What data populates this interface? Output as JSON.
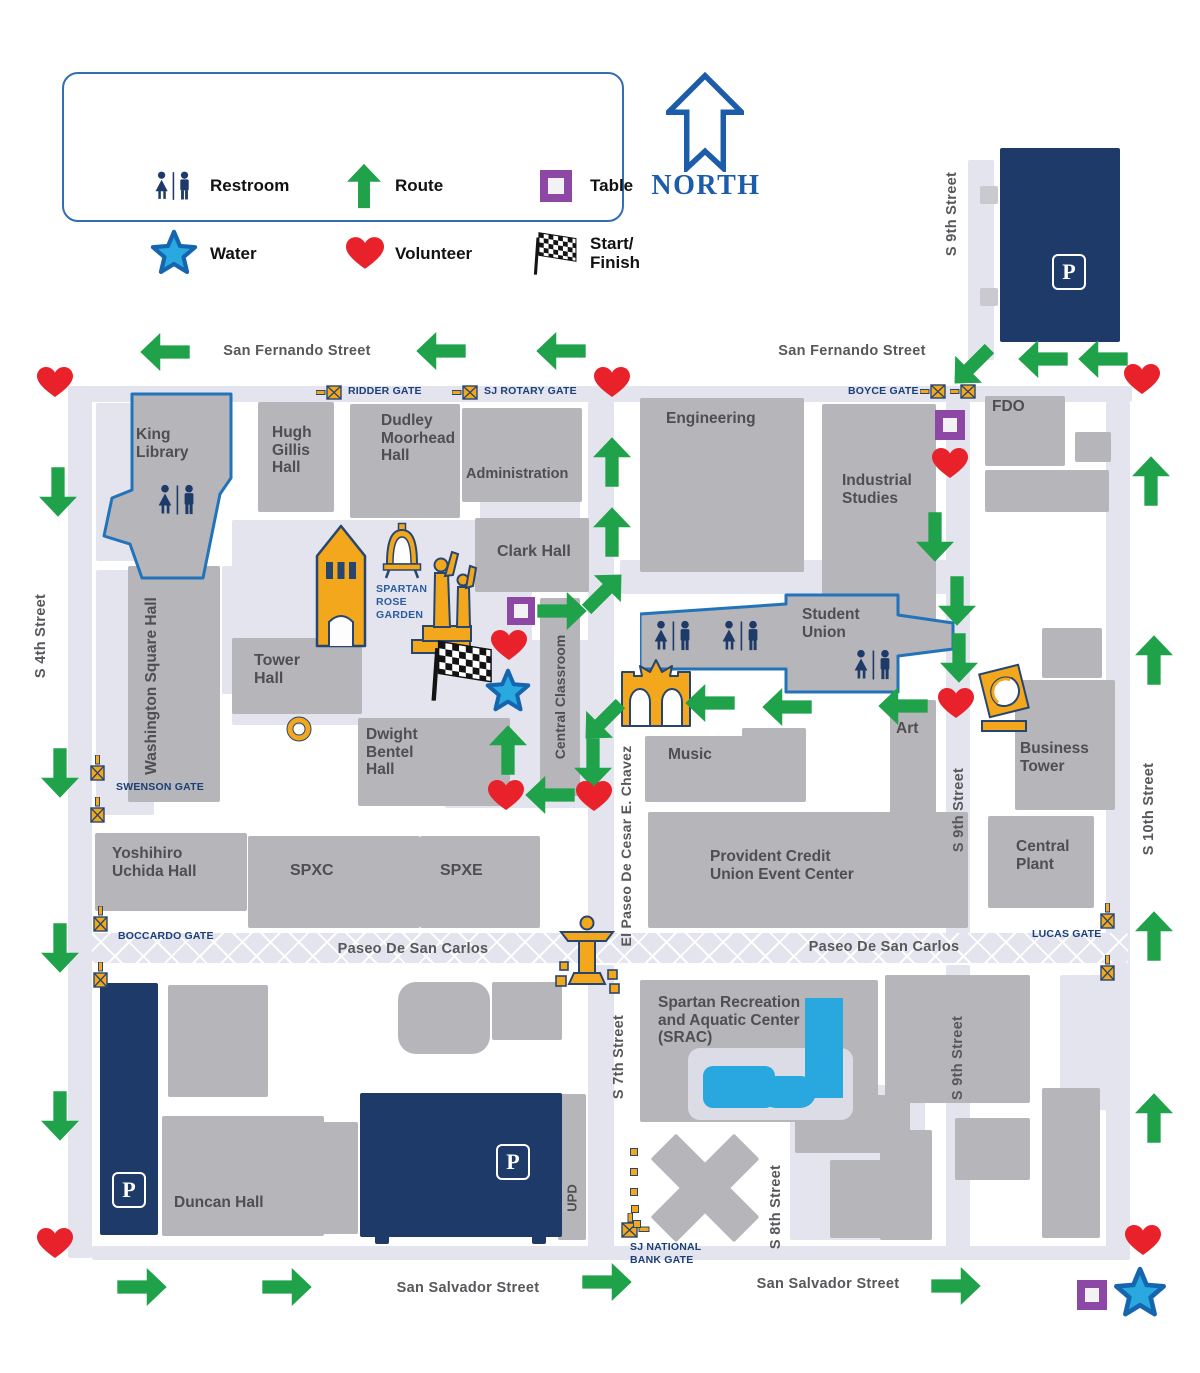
{
  "colors": {
    "green": "#1FA24A",
    "red": "#E8212B",
    "navy": "#1E3A68",
    "gold": "#F3A71D",
    "goldStroke": "#27466F",
    "purple": "#8D48A5",
    "starFill": "#2AA9E1",
    "starStroke": "#1566AF",
    "building": "#B5B5BA",
    "path": "#E4E4EE",
    "buildingText": "#4F4F52",
    "streetText": "#58585C",
    "gateText": "#1B3F77",
    "blueOutline": "#2273B9",
    "northBlue": "#1D5CA9",
    "pool": "#29A8E0",
    "roseText": "#2B5D9E",
    "flagDark": "#131313"
  },
  "legend": {
    "box": {
      "x": 62,
      "y": 72,
      "w": 562,
      "h": 150
    },
    "items": [
      {
        "icon": "restroom-icon",
        "label": "Restroom",
        "ix": 112,
        "iy": 114,
        "lx": 148,
        "ly": 104
      },
      {
        "icon": "route-arrow-icon",
        "label": "Route",
        "ix": 302,
        "iy": 114,
        "lx": 333,
        "ly": 104
      },
      {
        "icon": "table-icon",
        "label": "Table",
        "ix": 494,
        "iy": 114,
        "lx": 528,
        "ly": 104
      },
      {
        "icon": "water-star-icon",
        "label": "Water",
        "ix": 112,
        "iy": 182,
        "lx": 148,
        "ly": 172
      },
      {
        "icon": "volunteer-heart-icon",
        "label": "Volunteer",
        "ix": 303,
        "iy": 182,
        "lx": 333,
        "ly": 172
      },
      {
        "icon": "start-finish-flag-icon",
        "label": "Start/\nFinish",
        "ix": 492,
        "iy": 182,
        "lx": 528,
        "ly": 162
      }
    ]
  },
  "north": {
    "label": "NORTH",
    "ax": 666,
    "ay": 72,
    "tx": 706,
    "ty": 186
  },
  "map": {
    "paths": [
      {
        "x": 68,
        "y": 386,
        "w": 1064,
        "h": 16
      },
      {
        "x": 68,
        "y": 386,
        "w": 24,
        "h": 872
      },
      {
        "x": 968,
        "y": 160,
        "w": 26,
        "h": 200
      },
      {
        "x": 946,
        "y": 402,
        "w": 24,
        "h": 533
      },
      {
        "x": 946,
        "y": 965,
        "w": 24,
        "h": 292
      },
      {
        "x": 1106,
        "y": 402,
        "w": 24,
        "h": 855
      },
      {
        "x": 92,
        "y": 933,
        "w": 1036,
        "h": 30,
        "hatch": true
      },
      {
        "x": 92,
        "y": 1246,
        "w": 1038,
        "h": 14
      },
      {
        "x": 588,
        "y": 402,
        "w": 26,
        "h": 533
      },
      {
        "x": 588,
        "y": 965,
        "w": 26,
        "h": 292
      },
      {
        "x": 232,
        "y": 520,
        "w": 300,
        "h": 205
      },
      {
        "x": 445,
        "y": 640,
        "w": 150,
        "h": 168
      },
      {
        "x": 96,
        "y": 403,
        "w": 40,
        "h": 158
      },
      {
        "x": 96,
        "y": 570,
        "w": 58,
        "h": 245
      },
      {
        "x": 222,
        "y": 566,
        "w": 42,
        "h": 128
      },
      {
        "x": 480,
        "y": 500,
        "w": 100,
        "h": 20
      },
      {
        "x": 1060,
        "y": 975,
        "w": 48,
        "h": 135
      },
      {
        "x": 790,
        "y": 1085,
        "w": 135,
        "h": 155
      },
      {
        "x": 620,
        "y": 560,
        "w": 330,
        "h": 34
      }
    ],
    "buildings": [
      {
        "x": 258,
        "y": 402,
        "w": 76,
        "h": 110,
        "label": "Hugh\nGillis\nHall",
        "lx": 272,
        "ly": 424,
        "fs": 15.5
      },
      {
        "x": 350,
        "y": 404,
        "w": 110,
        "h": 114,
        "label": "Dudley\nMoorhead\nHall",
        "lx": 381,
        "ly": 412,
        "fs": 15.5
      },
      {
        "x": 462,
        "y": 408,
        "w": 120,
        "h": 94,
        "label": "Administration",
        "lx": 466,
        "ly": 466,
        "fs": 14.5
      },
      {
        "x": 640,
        "y": 398,
        "w": 164,
        "h": 174,
        "label": "Engineering",
        "lx": 666,
        "ly": 410,
        "fs": 15.5
      },
      {
        "x": 822,
        "y": 404,
        "w": 114,
        "h": 220,
        "label": "Industrial\nStudies",
        "lx": 842,
        "ly": 472,
        "fs": 15.5
      },
      {
        "x": 985,
        "y": 396,
        "w": 80,
        "h": 70,
        "label": "FDO",
        "lx": 992,
        "ly": 398,
        "fs": 15.5
      },
      {
        "x": 475,
        "y": 518,
        "w": 114,
        "h": 74,
        "label": "Clark Hall",
        "lx": 497,
        "ly": 543,
        "fs": 16
      },
      {
        "x": 232,
        "y": 638,
        "w": 130,
        "h": 76,
        "label": "Tower\nHall",
        "lx": 254,
        "ly": 652,
        "fs": 16
      },
      {
        "x": 540,
        "y": 598,
        "w": 40,
        "h": 198,
        "vlabel": "Central Classroom",
        "cx": 560,
        "cy": 697,
        "fs": 14
      },
      {
        "x": 358,
        "y": 718,
        "w": 152,
        "h": 88,
        "label": "Dwight\nBentel\nHall",
        "lx": 366,
        "ly": 726,
        "fs": 15.5
      },
      {
        "x": 128,
        "y": 566,
        "w": 92,
        "h": 236,
        "vlabel": "Washington Square Hall",
        "cx": 152,
        "cy": 686,
        "fs": 15.5
      },
      {
        "x": 95,
        "y": 833,
        "w": 152,
        "h": 78,
        "label": "Yoshihiro\nUchida Hall",
        "lx": 112,
        "ly": 845,
        "fs": 15.5
      },
      {
        "x": 248,
        "y": 836,
        "w": 172,
        "h": 92,
        "label": "SPXC",
        "lx": 290,
        "ly": 862,
        "fs": 16
      },
      {
        "x": 420,
        "y": 836,
        "w": 120,
        "h": 92,
        "label": "SPXE",
        "lx": 440,
        "ly": 862,
        "fs": 16
      },
      {
        "x": 645,
        "y": 736,
        "w": 122,
        "h": 66,
        "label": "Music",
        "lx": 668,
        "ly": 746,
        "fs": 15.5
      },
      {
        "x": 890,
        "y": 700,
        "w": 46,
        "h": 118,
        "label": "Art",
        "lx": 896,
        "ly": 720,
        "fs": 15.5
      },
      {
        "x": 1015,
        "y": 680,
        "w": 100,
        "h": 130,
        "label": "Business\nTower",
        "lx": 1020,
        "ly": 740,
        "fs": 15.5
      },
      {
        "x": 988,
        "y": 816,
        "w": 106,
        "h": 92,
        "label": "Central\nPlant",
        "lx": 1016,
        "ly": 838,
        "fs": 15.5
      },
      {
        "x": 648,
        "y": 812,
        "w": 320,
        "h": 116,
        "label": "Provident Credit\nUnion Event Center",
        "lx": 710,
        "ly": 848,
        "fs": 15.5
      },
      {
        "x": 640,
        "y": 980,
        "w": 238,
        "h": 142,
        "label": "Spartan Recreation\nand Aquatic Center\n(SRAC)",
        "lx": 658,
        "ly": 994,
        "fs": 15.5
      },
      {
        "x": 162,
        "y": 1116,
        "w": 162,
        "h": 120,
        "label": "Duncan Hall",
        "lx": 174,
        "ly": 1194,
        "fs": 15.5
      },
      {
        "x": 558,
        "y": 1094,
        "w": 28,
        "h": 146,
        "vlabel": "UPD",
        "cx": 572,
        "cy": 1198,
        "fs": 13
      },
      {
        "x": 885,
        "y": 975,
        "w": 145,
        "h": 128
      },
      {
        "x": 985,
        "y": 470,
        "w": 124,
        "h": 42
      },
      {
        "x": 1042,
        "y": 628,
        "w": 60,
        "h": 50
      },
      {
        "x": 880,
        "y": 1130,
        "w": 52,
        "h": 110
      },
      {
        "x": 955,
        "y": 1118,
        "w": 75,
        "h": 62
      },
      {
        "x": 1042,
        "y": 1088,
        "w": 58,
        "h": 150
      },
      {
        "x": 168,
        "y": 985,
        "w": 100,
        "h": 112
      },
      {
        "x": 300,
        "y": 1122,
        "w": 58,
        "h": 112
      },
      {
        "x": 398,
        "y": 982,
        "w": 92,
        "h": 72,
        "r": 18
      },
      {
        "x": 492,
        "y": 982,
        "w": 70,
        "h": 58
      },
      {
        "x": 795,
        "y": 1095,
        "w": 115,
        "h": 58
      },
      {
        "x": 830,
        "y": 1160,
        "w": 80,
        "h": 78
      },
      {
        "x": 742,
        "y": 728,
        "w": 64,
        "h": 74
      },
      {
        "x": 1075,
        "y": 432,
        "w": 36,
        "h": 30
      },
      {
        "x": 687,
        "y": 1129,
        "w": 36,
        "h": 118,
        "rot": 45
      },
      {
        "x": 646,
        "y": 1170,
        "w": 118,
        "h": 36,
        "rot": 45
      },
      {
        "x": 980,
        "y": 186,
        "w": 18,
        "h": 18,
        "color": "#C9C9CF"
      },
      {
        "x": 980,
        "y": 288,
        "w": 18,
        "h": 18,
        "color": "#C9C9CF"
      },
      {
        "x": 375,
        "y": 1235,
        "w": 14,
        "h": 9,
        "color": "#1E3A68"
      },
      {
        "x": 532,
        "y": 1235,
        "w": 14,
        "h": 9,
        "color": "#1E3A68"
      }
    ],
    "king_library": {
      "x": 100,
      "y": 392,
      "w": 135,
      "h": 188,
      "points": "32,2 131,2 131,86 120,102 103,186 42,186 30,152 4,144 12,106 32,98",
      "label": "King\nLibrary",
      "lx": 36,
      "ly": 34,
      "fs": 15.5,
      "restroom": [
        56,
        92
      ]
    },
    "student_union": {
      "x": 640,
      "y": 593,
      "w": 315,
      "h": 102,
      "points": "0,21 146,11 146,2 258,2 258,22 313,30 313,56 258,63 258,99 146,99 146,76 0,76",
      "label": "Student\nUnion",
      "lx": 162,
      "ly": 13,
      "fs": 15.5,
      "restrooms": [
        [
          12,
          27
        ],
        [
          80,
          27
        ],
        [
          212,
          56
        ]
      ]
    },
    "parking": [
      {
        "x": 1000,
        "y": 148,
        "w": 120,
        "h": 194,
        "bx": 1052,
        "by": 254
      },
      {
        "x": 100,
        "y": 983,
        "w": 58,
        "h": 252,
        "bx": 112,
        "by": 1172
      },
      {
        "x": 360,
        "y": 1093,
        "w": 202,
        "h": 144,
        "bx": 496,
        "by": 1144
      }
    ],
    "parking_badge_label": "P",
    "pools": {
      "deck": {
        "x": 688,
        "y": 1048,
        "w": 165,
        "h": 72
      },
      "rect": {
        "x": 805,
        "y": 998,
        "w": 38,
        "h": 100
      },
      "blob": [
        {
          "x": 703,
          "y": 1066,
          "w": 72,
          "h": 42,
          "r": 10
        },
        {
          "x": 760,
          "y": 1076,
          "w": 56,
          "h": 32,
          "r": 16
        }
      ]
    },
    "street_labels": [
      {
        "t": "San Fernando Street",
        "x": 297,
        "y": 351,
        "o": "h",
        "fs": 14.5
      },
      {
        "t": "San Fernando Street",
        "x": 852,
        "y": 351,
        "o": "h",
        "fs": 14.5
      },
      {
        "t": "Paseo De San Carlos",
        "x": 413,
        "y": 949,
        "o": "h",
        "fs": 14.5
      },
      {
        "t": "Paseo De San Carlos",
        "x": 884,
        "y": 947,
        "o": "h",
        "fs": 14.5
      },
      {
        "t": "San Salvador Street",
        "x": 468,
        "y": 1288,
        "o": "h",
        "fs": 14.5
      },
      {
        "t": "San Salvador Street",
        "x": 828,
        "y": 1284,
        "o": "h",
        "fs": 14.5
      },
      {
        "t": "S 4th Street",
        "x": 41,
        "y": 636,
        "o": "v",
        "fs": 14.5
      },
      {
        "t": "S 9th Street",
        "x": 952,
        "y": 214,
        "o": "v",
        "fs": 14.5
      },
      {
        "t": "S 9th Street",
        "x": 959,
        "y": 810,
        "o": "v",
        "fs": 14.5
      },
      {
        "t": "S 9th Street",
        "x": 958,
        "y": 1058,
        "o": "v",
        "fs": 14.5
      },
      {
        "t": "S 10th Street",
        "x": 1149,
        "y": 809,
        "o": "v",
        "fs": 14.5
      },
      {
        "t": "S 7th Street",
        "x": 619,
        "y": 1057,
        "o": "v",
        "fs": 14.5
      },
      {
        "t": "S 8th Street",
        "x": 776,
        "y": 1207,
        "o": "v",
        "fs": 14.5
      },
      {
        "t": "El Paseo De Cesar E. Chavez",
        "x": 626,
        "y": 846,
        "o": "v",
        "fs": 14
      }
    ],
    "gates": [
      {
        "name": "RIDDER GATE",
        "lx": 348,
        "ly": 385,
        "icons": [
          {
            "x": 316,
            "y": 385,
            "o": "h"
          }
        ]
      },
      {
        "name": "SJ ROTARY GATE",
        "lx": 484,
        "ly": 385,
        "icons": [
          {
            "x": 452,
            "y": 385,
            "o": "h"
          }
        ]
      },
      {
        "name": "BOYCE GATE",
        "lx": 848,
        "ly": 385,
        "icons": [
          {
            "x": 920,
            "y": 384,
            "o": "h"
          },
          {
            "x": 950,
            "y": 384,
            "o": "h"
          }
        ]
      },
      {
        "name": "SWENSON GATE",
        "lx": 116,
        "ly": 781,
        "icons": [
          {
            "x": 90,
            "y": 755,
            "o": "v"
          },
          {
            "x": 90,
            "y": 797,
            "o": "v"
          }
        ]
      },
      {
        "name": "BOCCARDO GATE",
        "lx": 118,
        "ly": 930,
        "icons": [
          {
            "x": 93,
            "y": 906,
            "o": "v"
          },
          {
            "x": 93,
            "y": 962,
            "o": "v"
          }
        ]
      },
      {
        "name": "LUCAS GATE",
        "lx": 1032,
        "ly": 928,
        "icons": [
          {
            "x": 1100,
            "y": 903,
            "o": "v"
          },
          {
            "x": 1100,
            "y": 955,
            "o": "v"
          }
        ]
      },
      {
        "name": "SJ NATIONAL\nBANK GATE",
        "lx": 630,
        "ly": 1241,
        "icons": [
          {
            "x": 620,
            "y": 1213,
            "o": "c"
          }
        ]
      }
    ],
    "landmarks": [
      {
        "type": "tower",
        "x": 314,
        "y": 524
      },
      {
        "type": "bell",
        "x": 382,
        "y": 522
      },
      {
        "type": "statues",
        "x": 410,
        "y": 550
      },
      {
        "type": "arch",
        "x": 620,
        "y": 658
      },
      {
        "type": "fountain",
        "x": 554,
        "y": 914
      },
      {
        "type": "sculpture",
        "x": 976,
        "y": 653
      },
      {
        "type": "ring",
        "x": 286,
        "y": 716
      }
    ],
    "rose_label": {
      "t": "SPARTAN\nROSE\nGARDEN",
      "x": 376,
      "y": 583
    },
    "arrows": [
      [
        165,
        352,
        270
      ],
      [
        441,
        351,
        270
      ],
      [
        561,
        351,
        270
      ],
      [
        972,
        366,
        225
      ],
      [
        1043,
        359,
        270
      ],
      [
        1103,
        359,
        270
      ],
      [
        1151,
        481,
        0
      ],
      [
        1154,
        660,
        0
      ],
      [
        1154,
        936,
        0
      ],
      [
        1154,
        1118,
        0
      ],
      [
        58,
        492,
        180
      ],
      [
        60,
        773,
        180
      ],
      [
        60,
        948,
        180
      ],
      [
        60,
        1116,
        180
      ],
      [
        612,
        462,
        0
      ],
      [
        612,
        532,
        0
      ],
      [
        604,
        592,
        45
      ],
      [
        562,
        611,
        90
      ],
      [
        935,
        537,
        180
      ],
      [
        957,
        601,
        180
      ],
      [
        959,
        658,
        180
      ],
      [
        710,
        703,
        270
      ],
      [
        787,
        707,
        270
      ],
      [
        903,
        706,
        270
      ],
      [
        508,
        750,
        0
      ],
      [
        550,
        795,
        270
      ],
      [
        603,
        721,
        225
      ],
      [
        593,
        763,
        180
      ],
      [
        142,
        1287,
        90
      ],
      [
        287,
        1287,
        90
      ],
      [
        607,
        1282,
        90
      ],
      [
        956,
        1286,
        90
      ]
    ],
    "hearts": [
      [
        55,
        383
      ],
      [
        612,
        383
      ],
      [
        1142,
        380
      ],
      [
        950,
        464
      ],
      [
        509,
        646
      ],
      [
        956,
        704
      ],
      [
        506,
        796
      ],
      [
        594,
        797
      ],
      [
        55,
        1244
      ],
      [
        1143,
        1241
      ]
    ],
    "stars": [
      {
        "x": 508,
        "y": 692,
        "s": 48
      },
      {
        "x": 1140,
        "y": 1294,
        "s": 56
      }
    ],
    "tables": [
      {
        "x": 521,
        "y": 611,
        "s": 28
      },
      {
        "x": 950,
        "y": 425,
        "s": 30
      },
      {
        "x": 1092,
        "y": 1295,
        "s": 30
      }
    ],
    "flags": [
      {
        "x": 426,
        "y": 640
      }
    ],
    "dots": [
      [
        630,
        1148
      ],
      [
        630,
        1168
      ],
      [
        630,
        1188
      ],
      [
        631,
        1205
      ],
      [
        633,
        1220
      ]
    ]
  }
}
